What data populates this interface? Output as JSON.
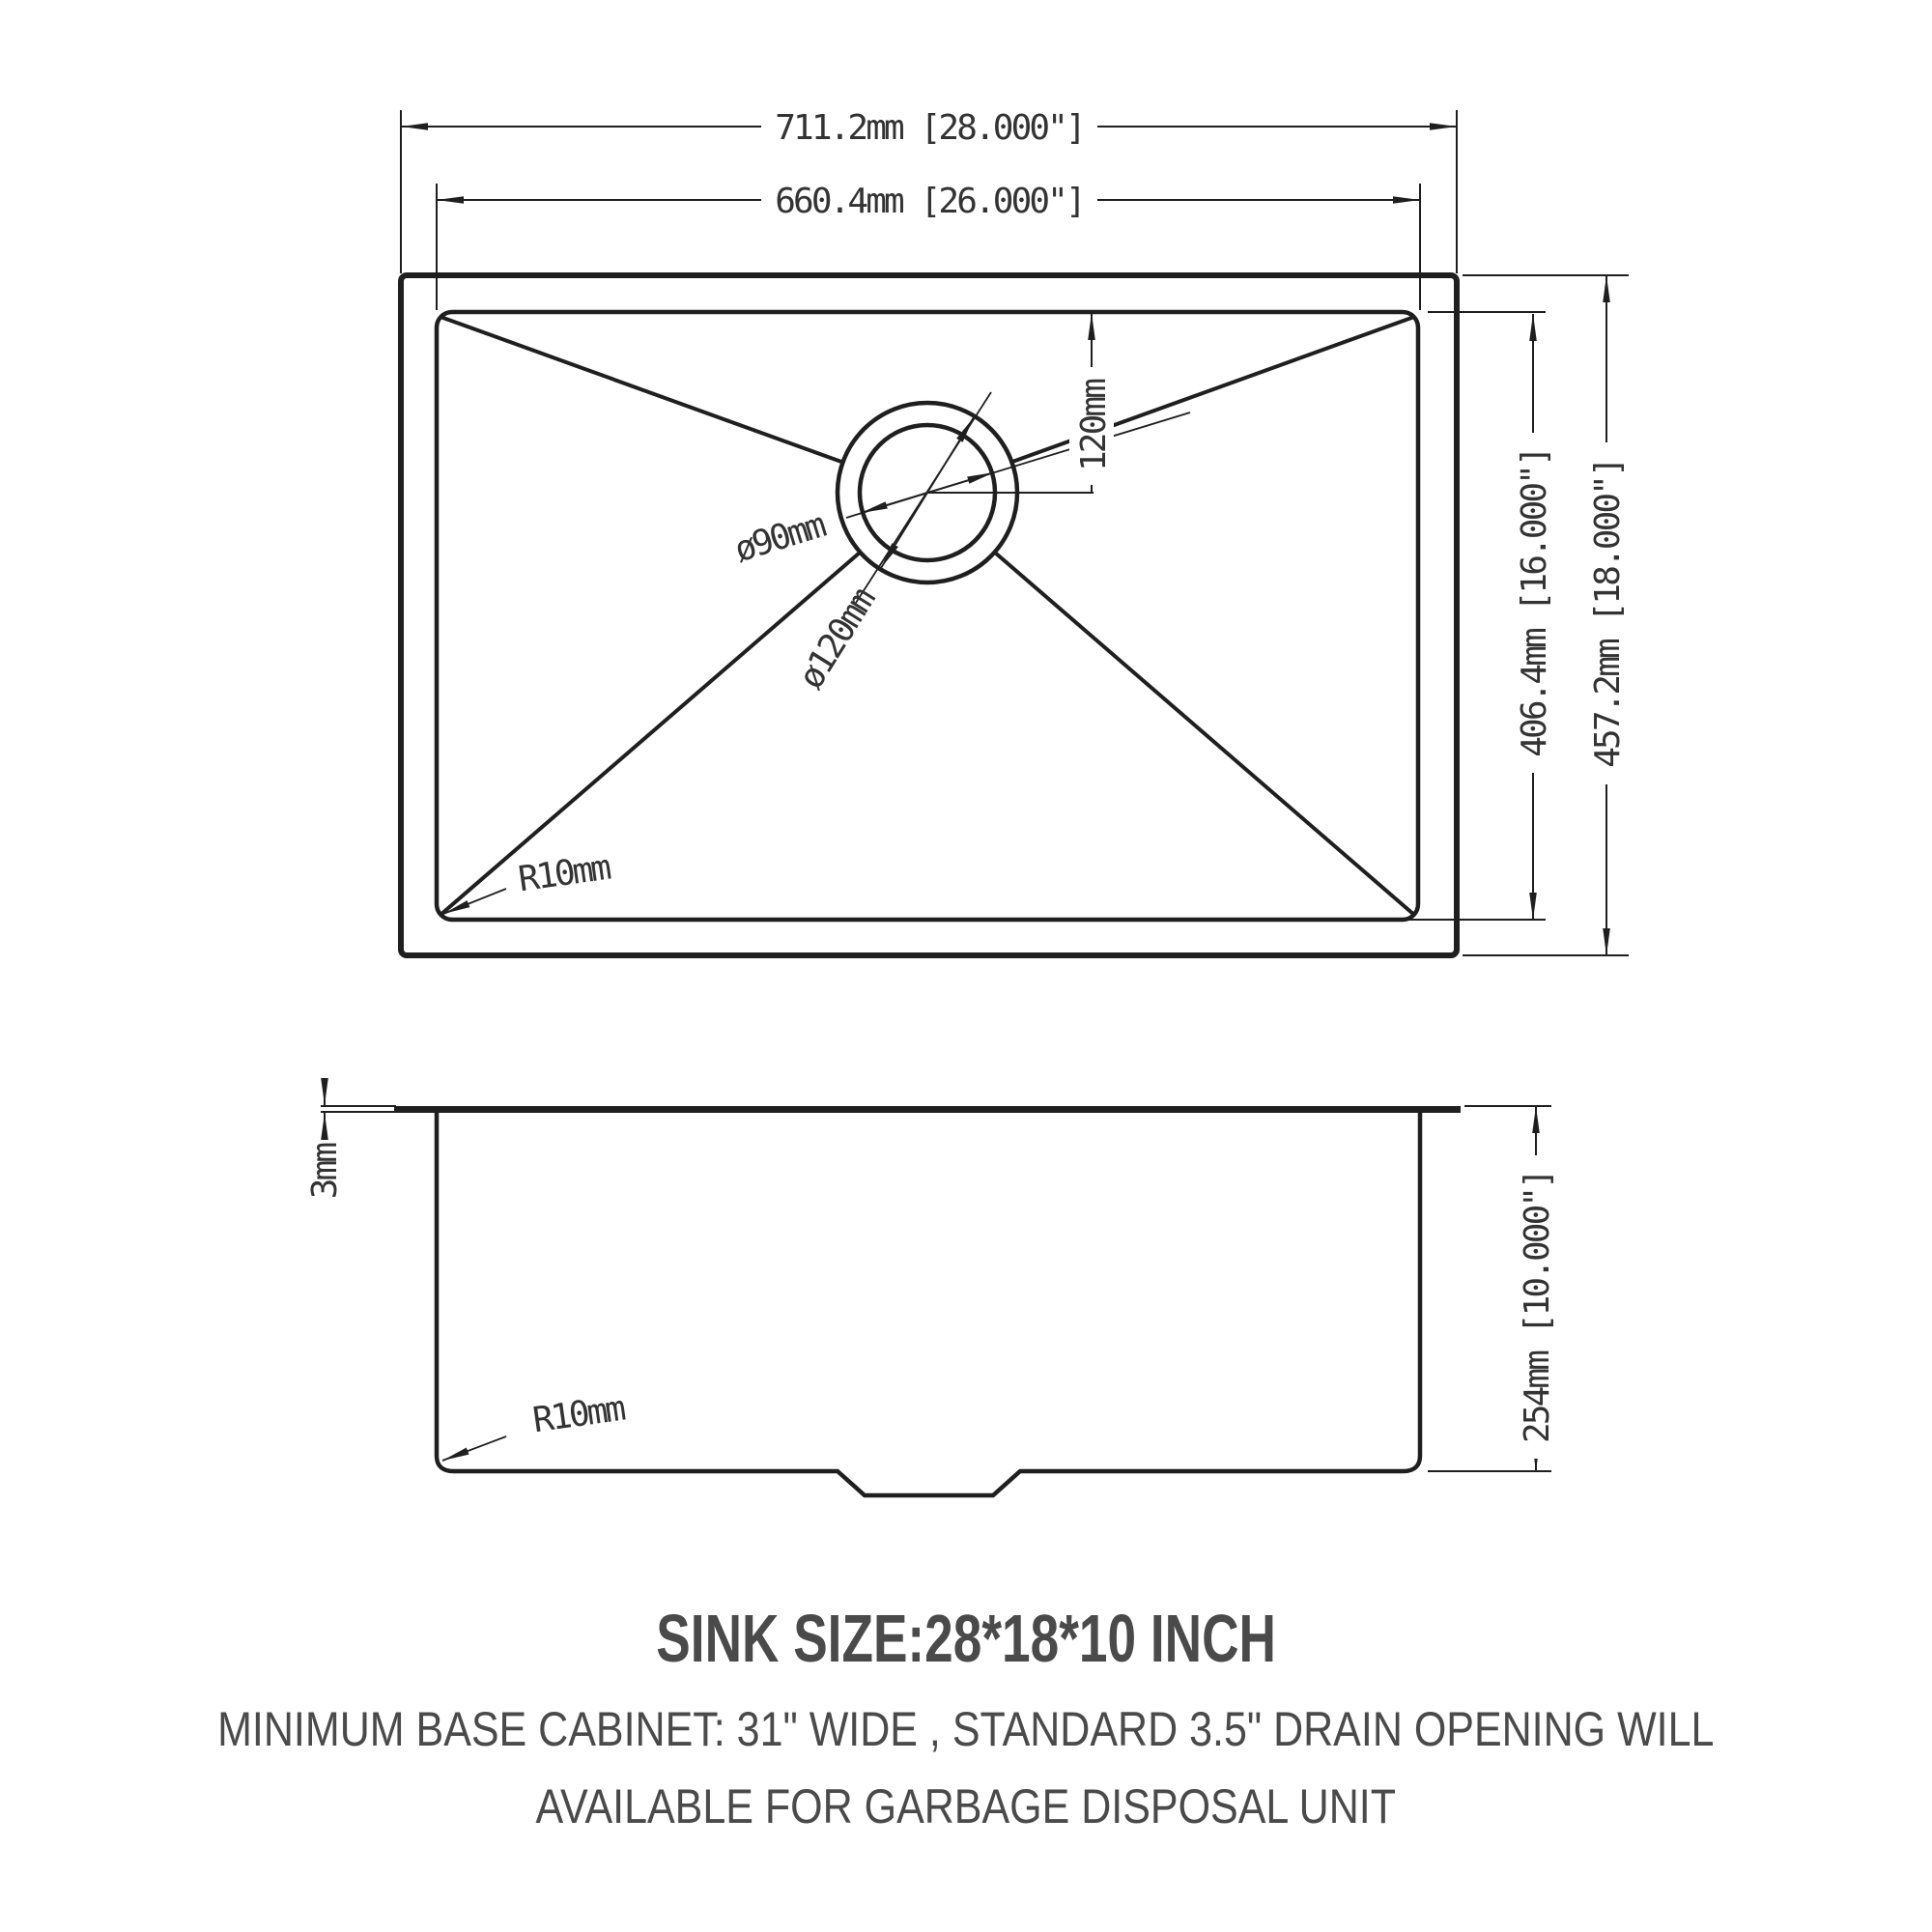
{
  "top_view": {
    "outer_width": "711.2mm [28.000\"]",
    "inner_width": "660.4mm [26.000\"]",
    "inner_depth": "406.4mm [16.000\"]",
    "outer_depth": "457.2mm [18.000\"]",
    "drain_offset": "120mm",
    "drain_inner_diameter": "ø90mm",
    "drain_outer_diameter": "ø120mm",
    "corner_radius": "R10mm"
  },
  "side_view": {
    "rim_thickness": "3mm",
    "bowl_depth": "254mm [10.000\"]",
    "corner_radius": "R10mm"
  },
  "caption": {
    "title": "SINK SIZE:28*18*10 INCH",
    "note_line1": "MINIMUM BASE CABINET: 31\" WIDE , STANDARD 3.5\" DRAIN OPENING WILL",
    "note_line2": "AVAILABLE FOR GARBAGE DISPOSAL UNIT"
  },
  "colors": {
    "line": "#1f1f1f",
    "dim_text": "#333333",
    "caption_text": "#4a4a4a"
  }
}
